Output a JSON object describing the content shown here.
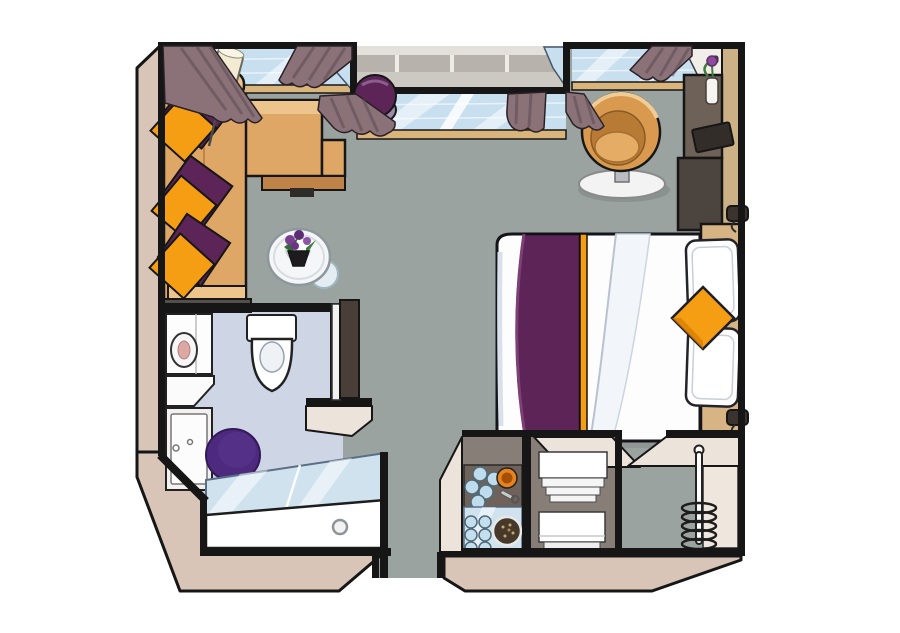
{
  "figure": {
    "kind": "hotel-room-floor-plan-illustration",
    "canvas": {
      "width": 900,
      "height": 633,
      "background": "#ffffff"
    }
  },
  "colors": {
    "wall": "#161616",
    "floor": "#9aa3a0",
    "bathFloor": "#ced5e5",
    "band": "#d8c5b7",
    "bandLight": "#ece3da",
    "glass": "#c8dfef",
    "sill": "#d9b57c",
    "curtain": "#8b7279",
    "curtainDark": "#5f4a53",
    "sofa": "#dfa765",
    "sofaLight": "#eec48d",
    "sofaDark": "#bf8348",
    "orange": "#f59d13",
    "orangeDark": "#d97f06",
    "plum": "#5c2457",
    "plumLight": "#9d8aa8",
    "rug": "#4e2a7e",
    "headboard": "#d6b484",
    "wardrobe": "#cdb186",
    "deskDark": "#6e6258",
    "deskDarker": "#4b443f",
    "chairTan": "#d99a50",
    "chairInner": "#b87b36",
    "chairSeat": "#e5ac66",
    "counter": "#6e625b",
    "shelfGlass": "#cfe2ee",
    "nicheBg": "#877f77",
    "lampCream": "#f3ead2",
    "duvet": "#fdfdfe",
    "duvetFold": "#f2f5f9",
    "railing": "#b7b2ac",
    "white": "#ffffff"
  },
  "rooms": [
    {
      "id": "living-sleeping-area"
    },
    {
      "id": "window-bay"
    },
    {
      "id": "bathroom"
    },
    {
      "id": "entry-corridor"
    },
    {
      "id": "minibar-niche"
    },
    {
      "id": "towel-shelf-niche"
    },
    {
      "id": "wardrobe-niche"
    }
  ],
  "items": [
    "l-shaped-sofa",
    "orange-cushions",
    "purple-throws",
    "floor-lamp",
    "side-table-with-flowers",
    "purple-ottoman",
    "tub-armchair",
    "double-bed",
    "bed-runner",
    "bed-pillows",
    "orange-bed-cushion",
    "headboard",
    "reading-lamps",
    "wardrobe",
    "desk-unit",
    "flower-vase",
    "tray",
    "curtains",
    "windows",
    "balcony-railing",
    "toilet",
    "vanity-with-basin",
    "bath-rug",
    "bathtub",
    "shower-glass-screen",
    "bathroom-door",
    "minibar-counter",
    "drinking-glasses",
    "snack-bowl",
    "bottle-opener",
    "glass-shelf",
    "serving-plate",
    "towel-stacks",
    "coat-stand"
  ]
}
